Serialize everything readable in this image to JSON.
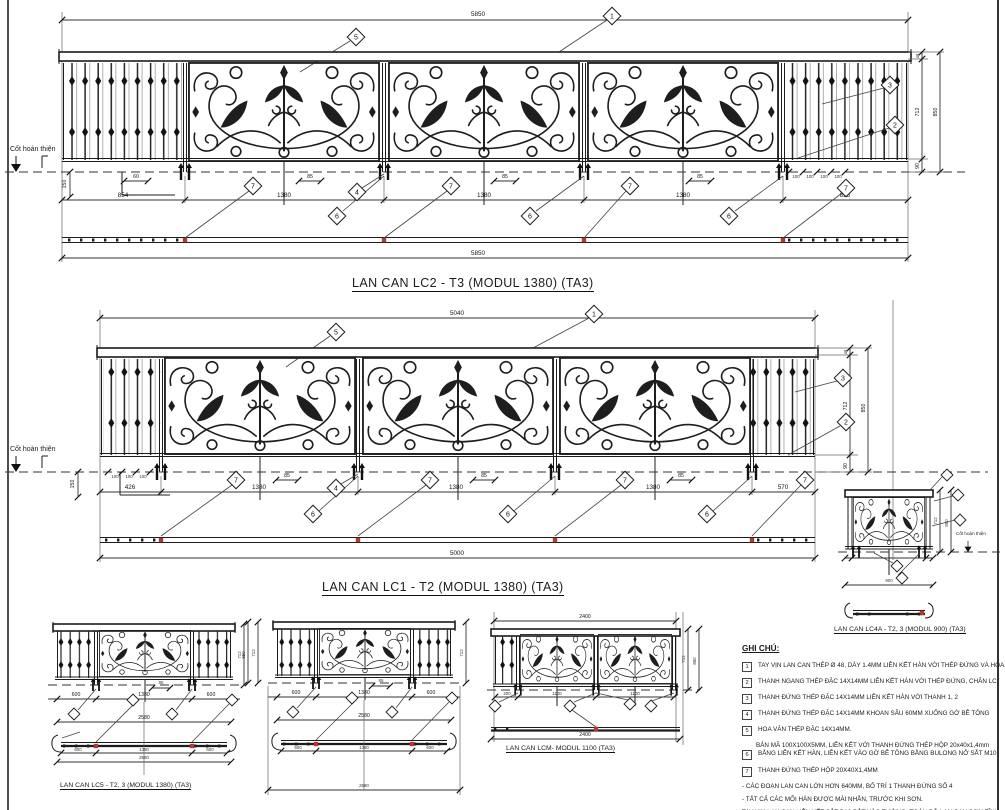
{
  "sheet": {
    "background": "#ffffff",
    "line_color": "#1c1c1c",
    "red_marker": "#b03a2e"
  },
  "level_label": "Cốt hoàn thiện",
  "top": {
    "title": "LAN CAN LC2 - T3 (MODUL 1380) (TA3)",
    "dim_total_top": "5850",
    "dim_total_bottom": "5850",
    "segs": [
      "854",
      "1380",
      "1380",
      "1380",
      "855"
    ],
    "dim_150": "150",
    "dim_60": "60",
    "panel_dims": [
      "85",
      "85",
      "85"
    ],
    "spacings": [
      "100",
      "100",
      "100",
      "100"
    ],
    "h48": "48",
    "h712": "712",
    "h90": "90",
    "h850": "850",
    "callouts": {
      "c1": "1",
      "c2": "2",
      "c3": "3",
      "c4": "4",
      "c5": "5",
      "c6": "6",
      "c7": "7"
    }
  },
  "mid": {
    "title": "LAN CAN LC1 - T2 (MODUL 1380) (TA3)",
    "dim_total_top": "5040",
    "dim_total_bottom": "5000",
    "segs": [
      "426",
      "1380",
      "1380",
      "1380",
      "570"
    ],
    "dim_150": "150",
    "panel_dims": [
      "85",
      "85",
      "85"
    ],
    "spacings": [
      "100",
      "100",
      "100"
    ],
    "h48": "48",
    "h712": "712",
    "h90": "90",
    "h850": "850",
    "callouts": {
      "c1": "1",
      "c2": "2",
      "c3": "3",
      "c4": "4",
      "c5": "5",
      "c6": "6",
      "c7": "7"
    }
  },
  "lc4a": {
    "label": "LAN CAN LC4A - T2, 3 (MODUL 900) (TA3)",
    "h712": "712",
    "h850": "850",
    "total": "900"
  },
  "lc5": {
    "label": "LAN CAN LC5 - T2, 3 (MODUL 1380)  (TA3)",
    "segs": [
      "600",
      "1380",
      "600"
    ],
    "total": "2580",
    "plan_segs": [
      "600",
      "1380",
      "600"
    ],
    "plan_total": "2580",
    "h712": "712",
    "dim_85": "85"
  },
  "lcb": {
    "segs": [
      "600",
      "1380",
      "600"
    ],
    "total": "2580",
    "plan_segs": [
      "600",
      "1380",
      "600"
    ],
    "plan_total": "2580",
    "h712": "712",
    "h850": "850",
    "dim_85": "85"
  },
  "lcm": {
    "label": "LAN CAN LCM- MODUL 1100 (TA3)",
    "dim_total_top": "2400",
    "segs": [
      "200",
      "1100",
      "1100"
    ],
    "dim_total_bottom": "2400",
    "h712": "712",
    "h850": "850"
  },
  "notes": {
    "heading": "GHI CHÚ:",
    "items": [
      {
        "n": "1",
        "t": "TAY VỊN LAN CAN THÉP Ø 48, DÀY 1.4MM LIÊN KẾT HÀN VỚI THÉP ĐỨNG VÀ HOA VĂN"
      },
      {
        "n": "2",
        "t": "THANH NGANG THÉP ĐẶC 14X14MM LIÊN KẾT HÀN VỚI THÉP ĐỨNG, CHÂN LC"
      },
      {
        "n": "3",
        "t": "THANH ĐỨNG THÉP ĐẶC 14X14MM LIÊN KẾT HÀN VỚI THANH 1, 2"
      },
      {
        "n": "4",
        "t": "THANH ĐỨNG THÉP ĐẶC 14X14MM KHOAN SÂU 60MM XUỐNG GỜ BÊ TÔNG"
      },
      {
        "n": "5",
        "t": "HOA VĂN THÉP ĐẶC 14X14MM."
      },
      {
        "n": "6",
        "t": "BẢN MÃ 100X100X5MM, LIÊN KẾT VỚI THANH ĐỨNG THÉP HỘP 20x40x1,4mm",
        "t2": "BẰNG LIÊN KẾT HÀN, LIÊN KẾT VÀO GỜ BÊ TÔNG BẰNG BULONG NỞ SẮT M10"
      },
      {
        "n": "7",
        "t": "THANH ĐỨNG THÉP HỘP 20X40X1,4MM"
      }
    ],
    "bullets": [
      "-   CÁC ĐOẠN LAN CAN LỚN HƠN 640MM, BỐ TRÍ  1 THANH ĐỨNG SỐ 4",
      "-   TẤT CẢ CÁC MỐI HÀN ĐƯỢC MÀI NHẴN, TRƯỚC KHI SƠN."
    ],
    "footer": [
      "TAY VỊN LAN CAN LIÊN KẾT  SẮT D10 BẮT VÀO TƯỜNG (TOÀN BỘ LAN CAN SƠN TĨNH",
      "ĐIỆN MÀU ĐEN SẪM, HOA VĂN ĐIỂM TRANG TRÍ SƠN MÀU VÀNG ĐỒNG)"
    ]
  }
}
